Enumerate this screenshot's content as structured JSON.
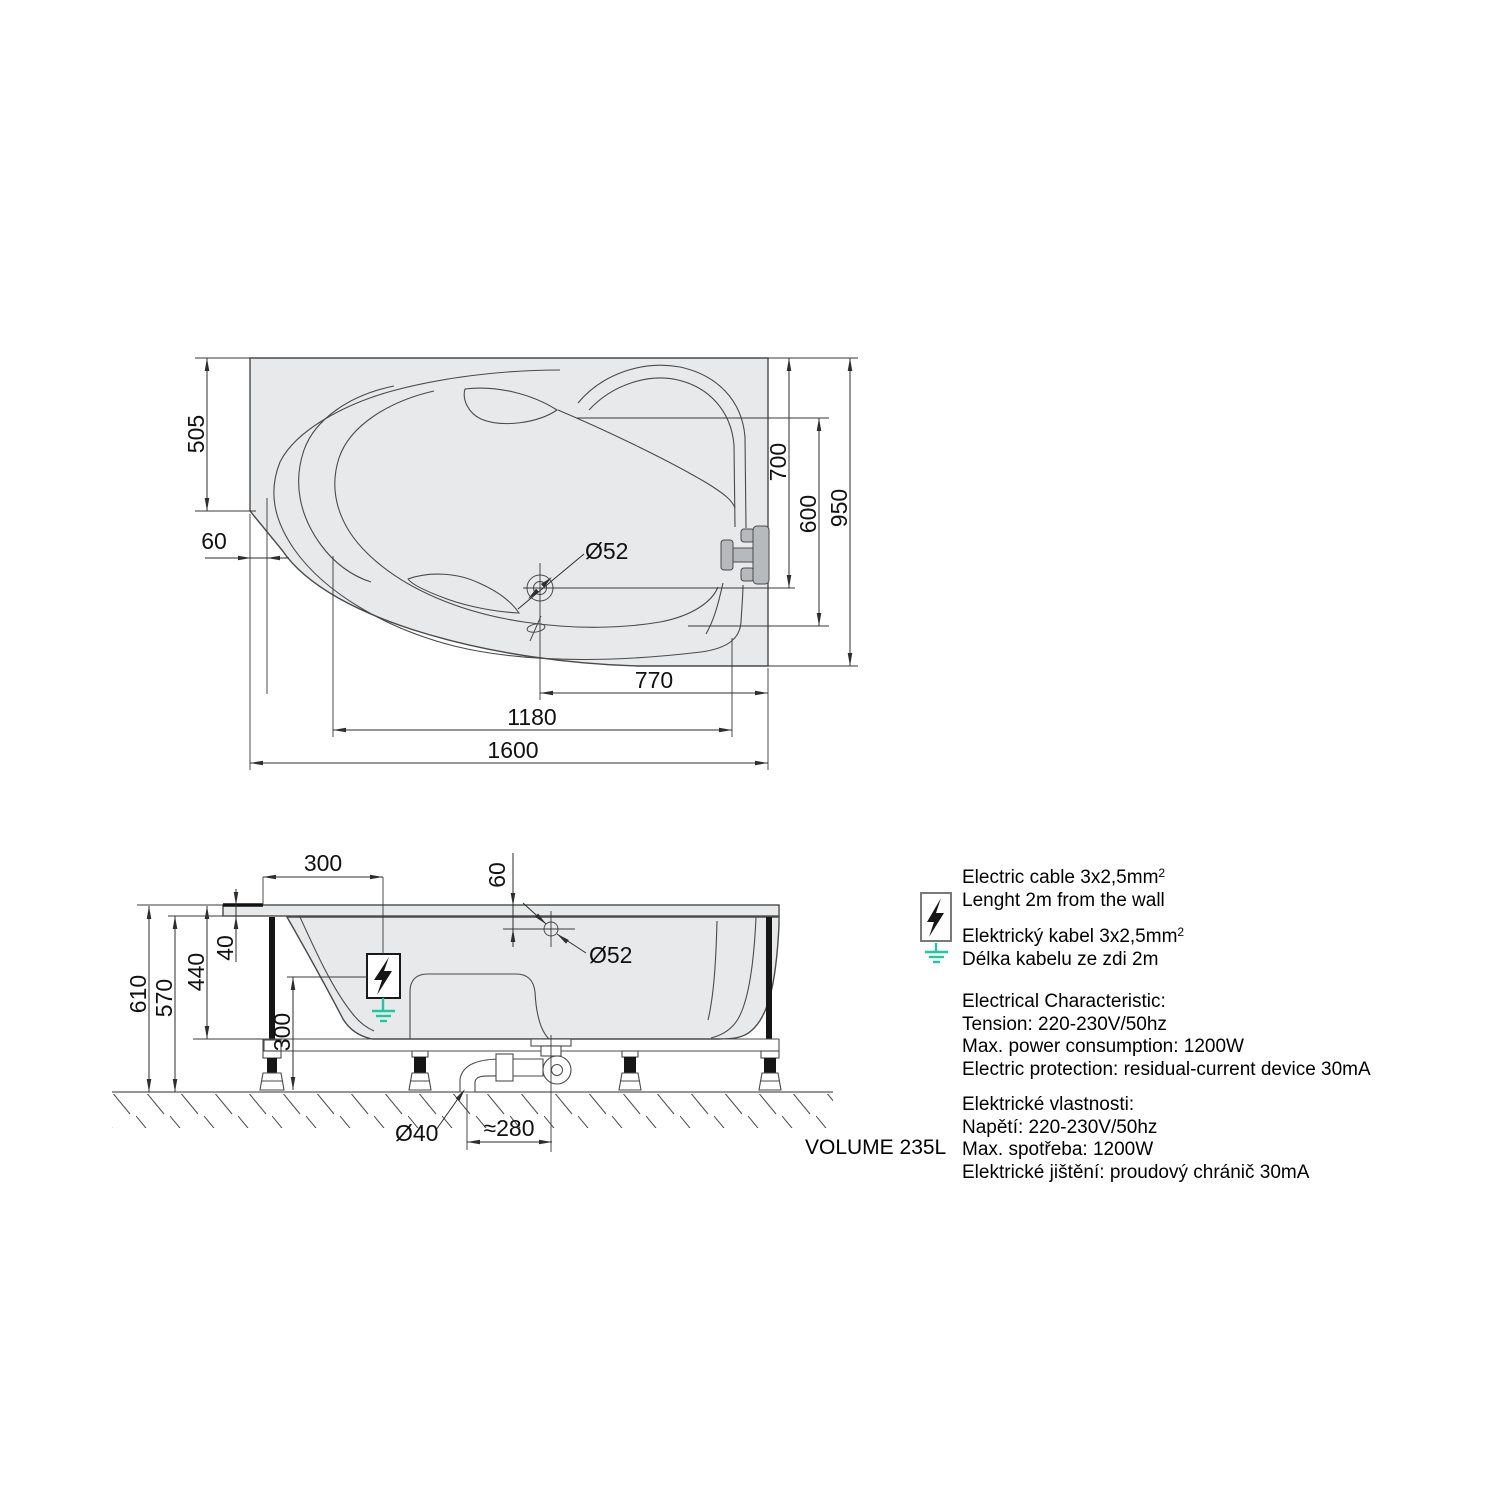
{
  "drawing_title": "Bathtub technical drawing",
  "colors": {
    "tub_fill": "#e8e9eb",
    "line": "#4a4a4a",
    "fixture_gray": "#b7babc",
    "earth_green": "#1ec8a0",
    "text": "#111111"
  },
  "top_view": {
    "dim_left_edge": "505",
    "dim_corner_offset": "60",
    "dim_drain_line": "700",
    "dim_backrest": "600",
    "dim_width": "950",
    "dim_drain_x": "770",
    "dim_inner_length": "1180",
    "dim_length": "1600",
    "drain_diameter": "Ø52"
  },
  "side_view": {
    "dim_cable_offset": "300",
    "dim_drain_offset": "60",
    "drain_diameter": "Ø52",
    "dim_rim": "40",
    "dim_shell_depth": "440",
    "dim_height_total": "610",
    "dim_height_shell": "570",
    "dim_clearance": "300",
    "waste_diameter": "Ø40",
    "dim_trap_offset": "≈280"
  },
  "notes": {
    "cable_en_line1": "Electric cable 3x2,5mm",
    "cable_sup": "2",
    "cable_en_line2": "Lenght 2m from the wall",
    "cable_cz_line1": "Elektrický kabel 3x2,5mm",
    "cable_cz_line2": "Délka kabelu ze zdi 2m",
    "spec_en_title": "Electrical Characteristic:",
    "spec_en_tension": "Tension: 220-230V/50hz",
    "spec_en_power": "Max. power consumption: 1200W",
    "spec_en_protection": "Electric protection: residual-current device 30mA",
    "spec_cz_title": "Elektrické vlastnosti:",
    "spec_cz_tension": "Napětí: 220-230V/50hz",
    "spec_cz_power": "Max. spotřeba: 1200W",
    "spec_cz_protection": "Elektrické jištění: proudový chránič 30mA",
    "volume": "VOLUME 235L"
  }
}
